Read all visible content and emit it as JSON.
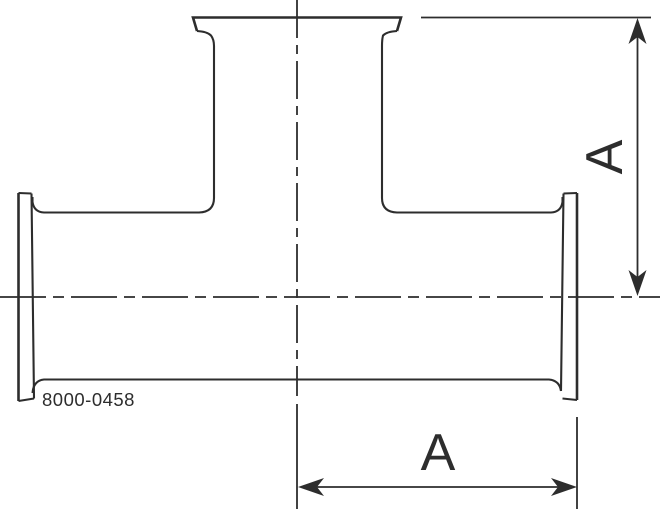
{
  "drawing": {
    "title": "tee-fitting-technical-drawing",
    "part_number": "8000-0458",
    "dimensions": {
      "vertical_label": "A",
      "horizontal_label": "A"
    },
    "colors": {
      "line": "#2d2d2d",
      "background": "#ffffff"
    }
  }
}
